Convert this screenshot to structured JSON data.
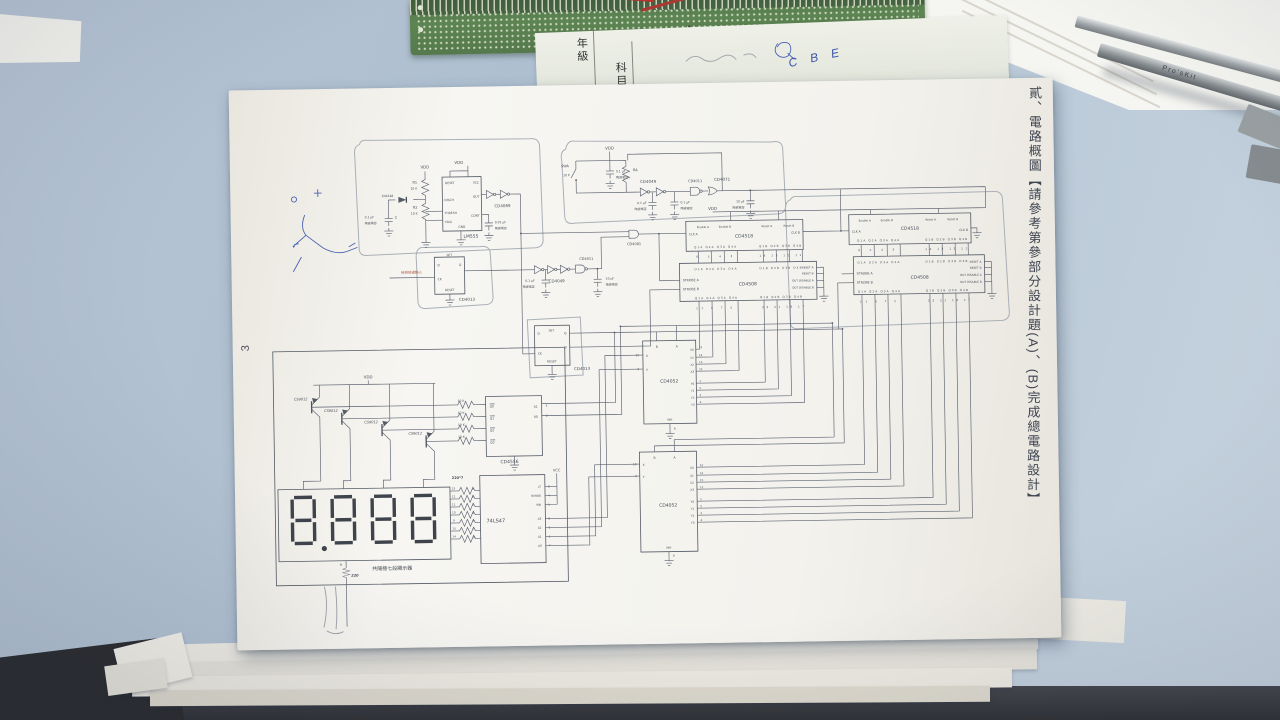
{
  "paper": {
    "side_title": "貳、電路概圖【請參考第參部分設計題(A)、(B)完成總電路設計】",
    "page_number": "3"
  },
  "worksheet": {
    "field_grade": "年級",
    "field_subject": "科目",
    "handwriting_blue": "C B E"
  },
  "tweezers": {
    "brand": "Pro'sKit"
  },
  "osc1": {
    "vdd": "VDD",
    "r1": "R1",
    "r1_val": "10 K",
    "r2": "R2",
    "r2_val": "10 K",
    "diode": "1N4148",
    "cap1": "0.1 μF",
    "cap1_type": "陶瓷電容",
    "cap1_name": "C",
    "chip": "LM555",
    "pin_reset": "RESET",
    "pin_vcc": "VCC",
    "pin_disch": "DISCH",
    "pin_out": "OUT",
    "pin_thresh": "THRESH",
    "pin_trig": "TRIG",
    "pin_cont": "CONT",
    "pin_gnd": "GND",
    "inv_chip": "CD4069",
    "cap2": "0.01 μF",
    "cap2_type": "陶瓷電容"
  },
  "debounce": {
    "input_label": "待測訊號輸入",
    "chip": "CD4013"
  },
  "shaper": {
    "cap1": "0.1 μF",
    "cap1_type": "陶瓷電容",
    "chip": "CD4049",
    "gate": "CD4011",
    "cap2": "10 μF",
    "cap2_type": "陶瓷電容"
  },
  "and_gate": {
    "chip": "CD4081"
  },
  "osc2": {
    "sw": "SWA",
    "r": "RA",
    "r_val": "10 K",
    "vdd": "VDD",
    "cap1": "0.1 μF",
    "cap1_type": "陶瓷電容",
    "chip": "CD4049",
    "cap2": "0.1 μF",
    "cap2_type": "陶瓷電容",
    "cap3": "0.1 μF",
    "cap3_type": "陶瓷電容",
    "gate1": "CD4011",
    "gate2": "CD4071",
    "cap4": "10 μF",
    "cap4_type": "陶瓷電容",
    "vdd2": "VDD"
  },
  "counter": {
    "chip": "CD4518",
    "en_a": "Enable A",
    "en_b": "Enable B",
    "rst_a": "Reset A",
    "rst_b": "Reset B",
    "clk_a": "CLK A",
    "clk_b": "CLK B",
    "q_a": "Q1A Q2A Q3A Q4A",
    "q_b": "Q1B Q2B Q3B Q4B",
    "nums_a": "6 5 4 3",
    "nums_b": "14 13 12 11"
  },
  "latch": {
    "chip": "CD4508",
    "d_a": "D1A D2A D3A D4A",
    "d_b": "D1B D2B D3B D4B",
    "strobe_a": "STROBE A",
    "strobe_b": "STROBE B",
    "rst_a": "RESET A",
    "rst_b": "RESET B",
    "dis_a": "OUT DISABLE A",
    "dis_b": "OUT DISABLE B",
    "q_a": "Q1A Q2A Q3A Q4A",
    "q_b": "Q1B Q2B Q3B Q4B",
    "nums_a": "11 9 7 5",
    "nums_b": "23 21 19 17"
  },
  "flipflop": {
    "chip": "CD4013",
    "set": "SET",
    "reset": "RESET",
    "d": "D",
    "ck": "CK",
    "q": "Q"
  },
  "mux": {
    "chip": "CD4052",
    "a": "A",
    "b": "B",
    "x": "X",
    "y": "Y",
    "inh": "INH",
    "x0": "X0",
    "x1": "X1",
    "x2": "X2",
    "x3": "X3",
    "y0": "Y0",
    "y1": "Y1",
    "y2": "Y2",
    "y3": "Y3",
    "n_x": "13",
    "n_y": "3",
    "n_x0": "12",
    "n_x1": "14",
    "n_x2": "15",
    "n_x3": "11",
    "n_y0": "1",
    "n_y1": "5",
    "n_y2": "2",
    "n_y3": "4",
    "n_inh": "6"
  },
  "display": {
    "vdd": "VDD",
    "transistor": "CS9012",
    "res": "10 K",
    "decoder": "CD4556",
    "q_col": [
      "Q0",
      "Q1",
      "Q2",
      "Q3"
    ],
    "a1": "A1",
    "a0": "A0",
    "n_a1": "3",
    "n_a0": "2",
    "seg_chip": "74LS47",
    "vcc": "VCC",
    "seg_letters": [
      "a",
      "b",
      "c",
      "d",
      "e",
      "f",
      "g"
    ],
    "pins": [
      "LT",
      "BI/RBO",
      "RBI",
      "A3",
      "A2",
      "A1",
      "A0"
    ],
    "pin_nums": [
      "3",
      "4",
      "5",
      "6",
      "2",
      "1",
      "7"
    ],
    "res_array": "220*7",
    "disp_pin_nums": [
      "13",
      "12",
      "11",
      "10",
      "9",
      "15",
      "14"
    ],
    "h_label": "h",
    "h_res": "220",
    "disp_label": "共陽極七段顯示器",
    "value": "8.888"
  }
}
